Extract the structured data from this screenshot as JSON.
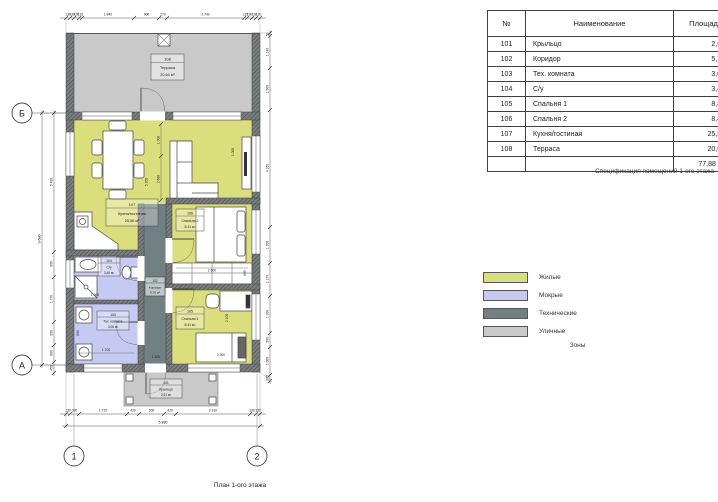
{
  "colors": {
    "residential": "#dbde7c",
    "wet": "#c6c9f2",
    "technical": "#708083",
    "outdoor": "#c9c9c9"
  },
  "table": {
    "headers": {
      "num": "№",
      "name": "Наименование",
      "area": "Площадь"
    },
    "rows": [
      {
        "num": "101",
        "name": "Крыльцо",
        "area": "2,61"
      },
      {
        "num": "102",
        "name": "Коридор",
        "area": "5,79"
      },
      {
        "num": "103",
        "name": "Тех. комната",
        "area": "3,06"
      },
      {
        "num": "104",
        "name": "С/у",
        "area": "3,40"
      },
      {
        "num": "105",
        "name": "Спальня 1",
        "area": "8,41"
      },
      {
        "num": "106",
        "name": "Спальня 2",
        "area": "8,41"
      },
      {
        "num": "107",
        "name": "Кухня/гостиная",
        "area": "25,56"
      },
      {
        "num": "108",
        "name": "Терраса",
        "area": "20,64"
      }
    ],
    "total": "77,88 м²",
    "caption": "Спецификация помещений 1-ого этажа"
  },
  "legend": {
    "title": "Зоны",
    "items": [
      {
        "label": "Жилые"
      },
      {
        "label": "Мокрые"
      },
      {
        "label": "Технические"
      },
      {
        "label": "Уличные"
      }
    ]
  },
  "plan": {
    "caption": "План 1-ого этажа",
    "axes": {
      "b": "Б",
      "a": "А",
      "n1": "1",
      "n2": "2"
    },
    "rooms": [
      {
        "number": "108",
        "name": "Терраса",
        "area": "20,64 м²"
      },
      {
        "number": "107",
        "name": "Кухня/гостиная",
        "area": "25,56 м²"
      },
      {
        "number": "106",
        "name": "Спальня 2",
        "area": "8,41 м²"
      },
      {
        "number": "105",
        "name": "Спальня 1",
        "area": "8,41 м²"
      },
      {
        "number": "104",
        "name": "С/у",
        "area": "3,40 м²"
      },
      {
        "number": "103",
        "name": "Тех. комната",
        "area": "3,06 м²"
      },
      {
        "number": "102",
        "name": "Коридор",
        "area": "5,79 м²"
      },
      {
        "number": "101",
        "name": "Крыльцо",
        "area": "2,61 м²"
      }
    ],
    "dims": {
      "top": [
        "130",
        "130",
        "190",
        "115",
        "1 840",
        "900",
        "270",
        "2 740",
        "115",
        "190",
        "130",
        "130"
      ],
      "bottom": [
        "130",
        "330",
        "1 710",
        "420",
        "900",
        "420",
        "2 910",
        "190",
        "130"
      ],
      "bottom_total": "6 880",
      "left": [
        "5 490",
        "900",
        "1 770",
        "900",
        "680",
        "450"
      ],
      "left_total": "9 680",
      "right": [
        "50",
        "1 140",
        "1 500",
        "4 160",
        "1 300",
        "1 170",
        "1 300",
        "500",
        "1 000",
        "200"
      ],
      "interior": [
        "1 000",
        "2 600",
        "5 300",
        "1 000",
        "2 900",
        "600",
        "2 100",
        "2 900",
        "1 000",
        "1 700",
        "800",
        "1 400"
      ]
    }
  }
}
